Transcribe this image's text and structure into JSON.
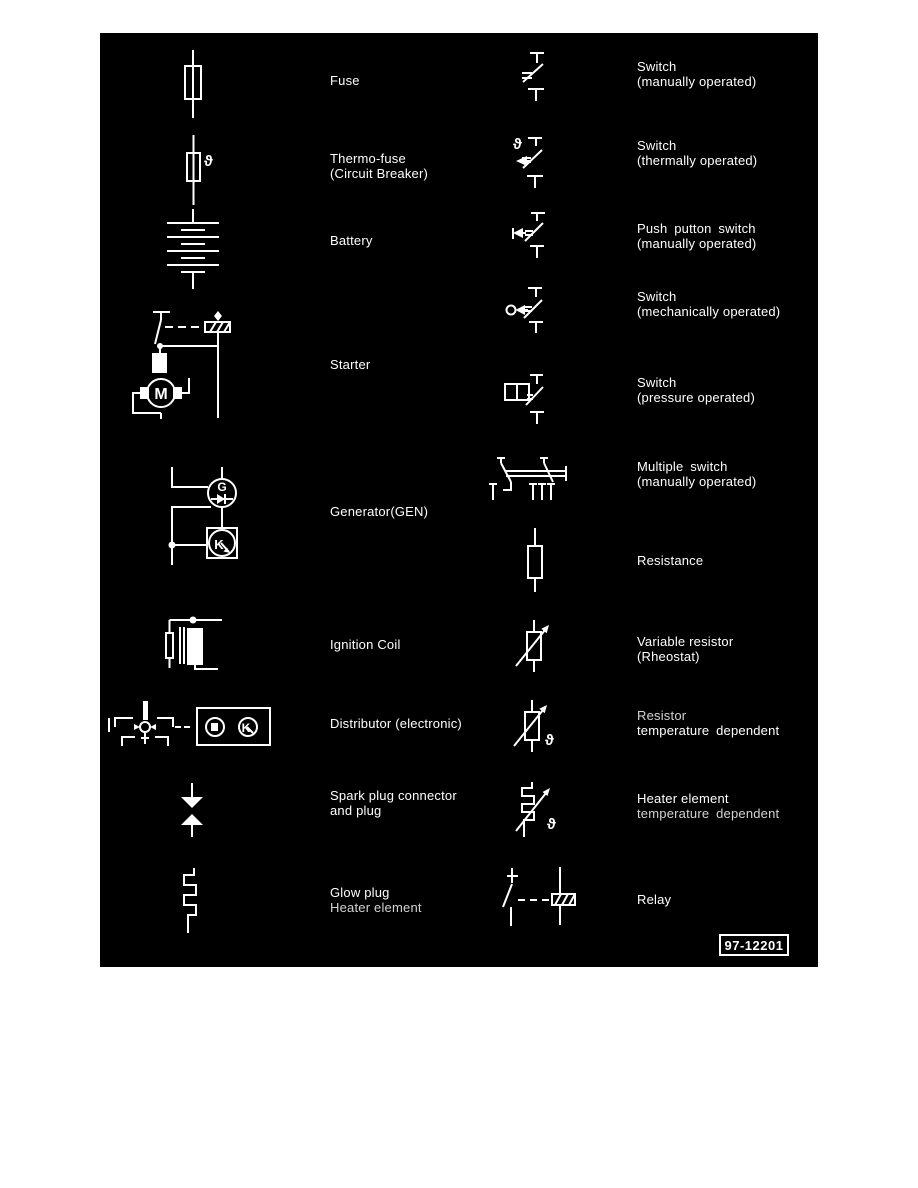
{
  "page": {
    "background": "#ffffff",
    "panel_background": "#000000",
    "symbol_color": "#ffffff"
  },
  "figure_ref": "97-12201",
  "glyphs": {
    "theta": "ϑ",
    "motor": "M",
    "generator": "G",
    "regulator": "K"
  },
  "legend": {
    "left": [
      {
        "icon": "fuse",
        "lines": [
          "Fuse"
        ]
      },
      {
        "icon": "thermo-fuse",
        "lines": [
          "Thermo-fuse",
          "(Circuit Breaker)"
        ]
      },
      {
        "icon": "battery",
        "lines": [
          "Battery"
        ]
      },
      {
        "icon": "starter",
        "lines": [
          "Starter"
        ]
      },
      {
        "icon": "generator",
        "lines": [
          "Generator(GEN)"
        ]
      },
      {
        "icon": "ignition-coil",
        "lines": [
          "Ignition Coil"
        ]
      },
      {
        "icon": "distributor",
        "lines": [
          "Distributor (electronic)"
        ]
      },
      {
        "icon": "spark-plug-connector",
        "lines": [
          "Spark plug connector",
          "and plug"
        ]
      },
      {
        "icon": "glow-plug",
        "lines": [
          "Glow plug",
          "Heater element"
        ]
      }
    ],
    "right": [
      {
        "icon": "switch-manually-operated",
        "lines": [
          "Switch",
          "(manually operated)"
        ]
      },
      {
        "icon": "switch-thermally-operated",
        "lines": [
          "Switch",
          "(thermally operated)"
        ]
      },
      {
        "icon": "push-button-switch",
        "lines": [
          "Push putton switch",
          "(manually operated)"
        ]
      },
      {
        "icon": "switch-mechanically-operated",
        "lines": [
          "Switch",
          "(mechanically operated)"
        ]
      },
      {
        "icon": "switch-pressure-operated",
        "lines": [
          "Switch",
          "(pressure operated)"
        ]
      },
      {
        "icon": "multiple-switch",
        "lines": [
          "Multiple switch",
          "(manually operated)"
        ]
      },
      {
        "icon": "resistance",
        "lines": [
          "Resistance"
        ]
      },
      {
        "icon": "variable-resistor",
        "lines": [
          "Variable resistor",
          "(Rheostat)"
        ]
      },
      {
        "icon": "resistor-temperature-dependent",
        "lines": [
          "Resistor",
          "temperature dependent"
        ]
      },
      {
        "icon": "heater-element-temperature-dependent",
        "lines": [
          "Heater element",
          "temperature dependent"
        ]
      },
      {
        "icon": "relay",
        "lines": [
          "Relay"
        ]
      }
    ]
  }
}
